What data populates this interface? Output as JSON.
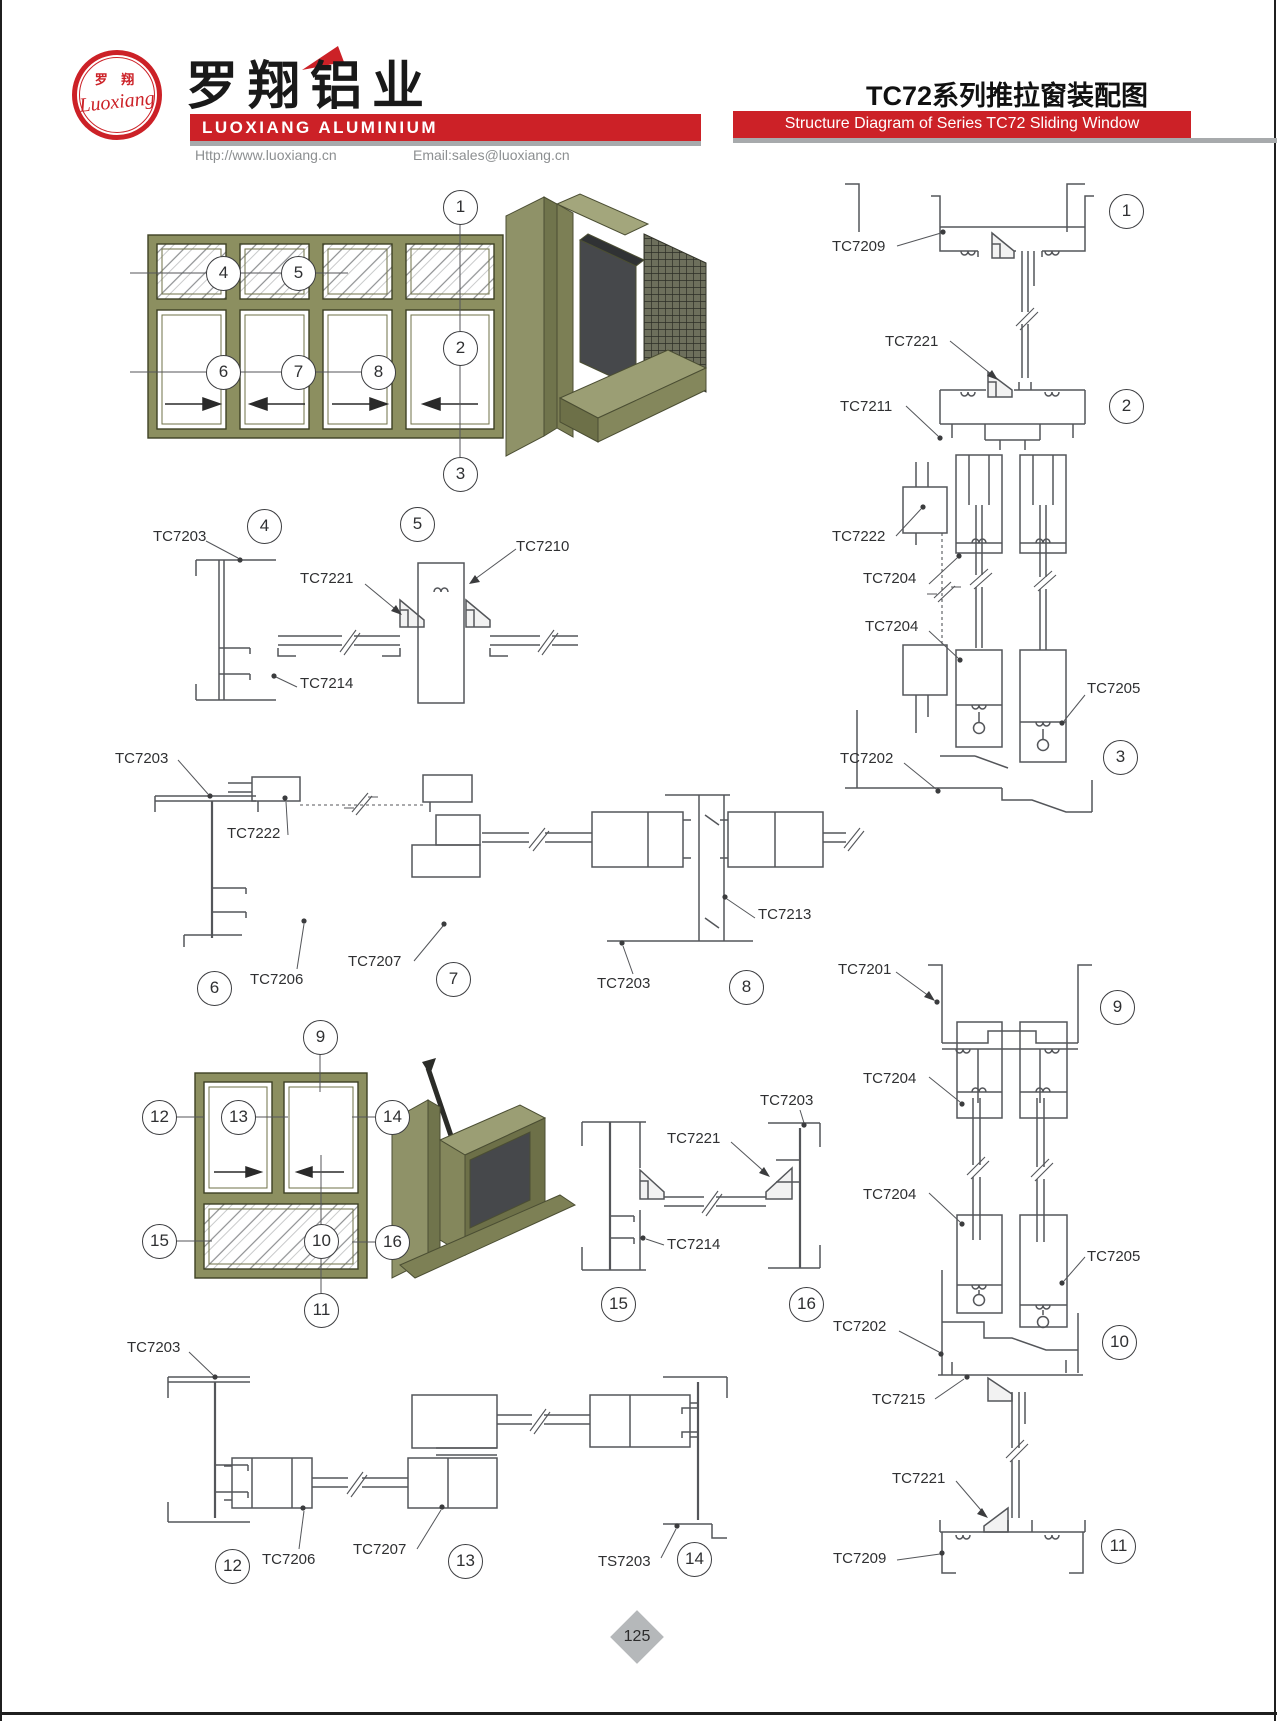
{
  "header": {
    "logo_cn": "罗 翔",
    "logo_script": "Luoxiang",
    "company_cn": "罗翔铝业",
    "company_en": "LUOXIANG ALUMINIUM",
    "url": "Http://www.luoxiang.cn",
    "email": "Email:sales@luoxiang.cn",
    "title_cn": "TC72系列推拉窗装配图",
    "title_en": "Structure Diagram of Series TC72 Sliding Window",
    "accent_red": "#cc2127"
  },
  "footer": {
    "page_number": "125"
  },
  "labels": [
    "TC7209",
    "TC7221",
    "TC7211",
    "TC7222",
    "TC7204",
    "TC7204",
    "TC7205",
    "TC7202",
    "TC7203",
    "TC7221",
    "TC7210",
    "TC7214",
    "TC7203",
    "TC7222",
    "TC7206",
    "TC7207",
    "TC7213",
    "TC7203",
    "TC7201",
    "TC7204",
    "TC7204",
    "TC7205",
    "TC7202",
    "TC7215",
    "TC7221",
    "TC7209",
    "TC7203",
    "TC7221",
    "TC7214",
    "TC7203",
    "TC7206",
    "TC7207",
    "TS7203"
  ],
  "callouts": [
    "1",
    "4",
    "5",
    "2",
    "6",
    "7",
    "8",
    "3",
    "1",
    "2",
    "3",
    "4",
    "5",
    "6",
    "7",
    "8",
    "9",
    "12",
    "13",
    "14",
    "15",
    "10",
    "16",
    "11",
    "15",
    "16",
    "9",
    "10",
    "11",
    "12",
    "13",
    "14"
  ]
}
